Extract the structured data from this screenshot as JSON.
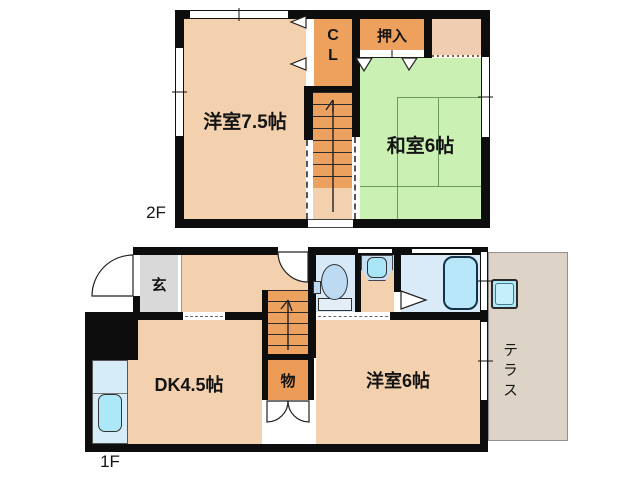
{
  "floor2": {
    "floor_label": "2F",
    "western_room": "洋室7.5帖",
    "japanese_room": "和室6帖",
    "closet_line1": "C",
    "closet_line2": "L",
    "oshiire": "押入"
  },
  "floor1": {
    "floor_label": "1F",
    "entrance": "玄",
    "dining_kitchen": "DK4.5帖",
    "storage": "物",
    "western_room": "洋室6帖",
    "terrace": "テラス"
  },
  "colors": {
    "wall": "#0d0d0d",
    "room_peach": "#f3d0ae",
    "closet_orange": "#eda15c",
    "stairs_orange": "#eca25e",
    "tatami_green": "#cbf0b3",
    "genkan_gray": "#d9d9d9",
    "water_floor_blue": "#d8eaf8",
    "fixture_cyan": "#ace8f8",
    "terrace_tan": "#ddd3c6"
  }
}
